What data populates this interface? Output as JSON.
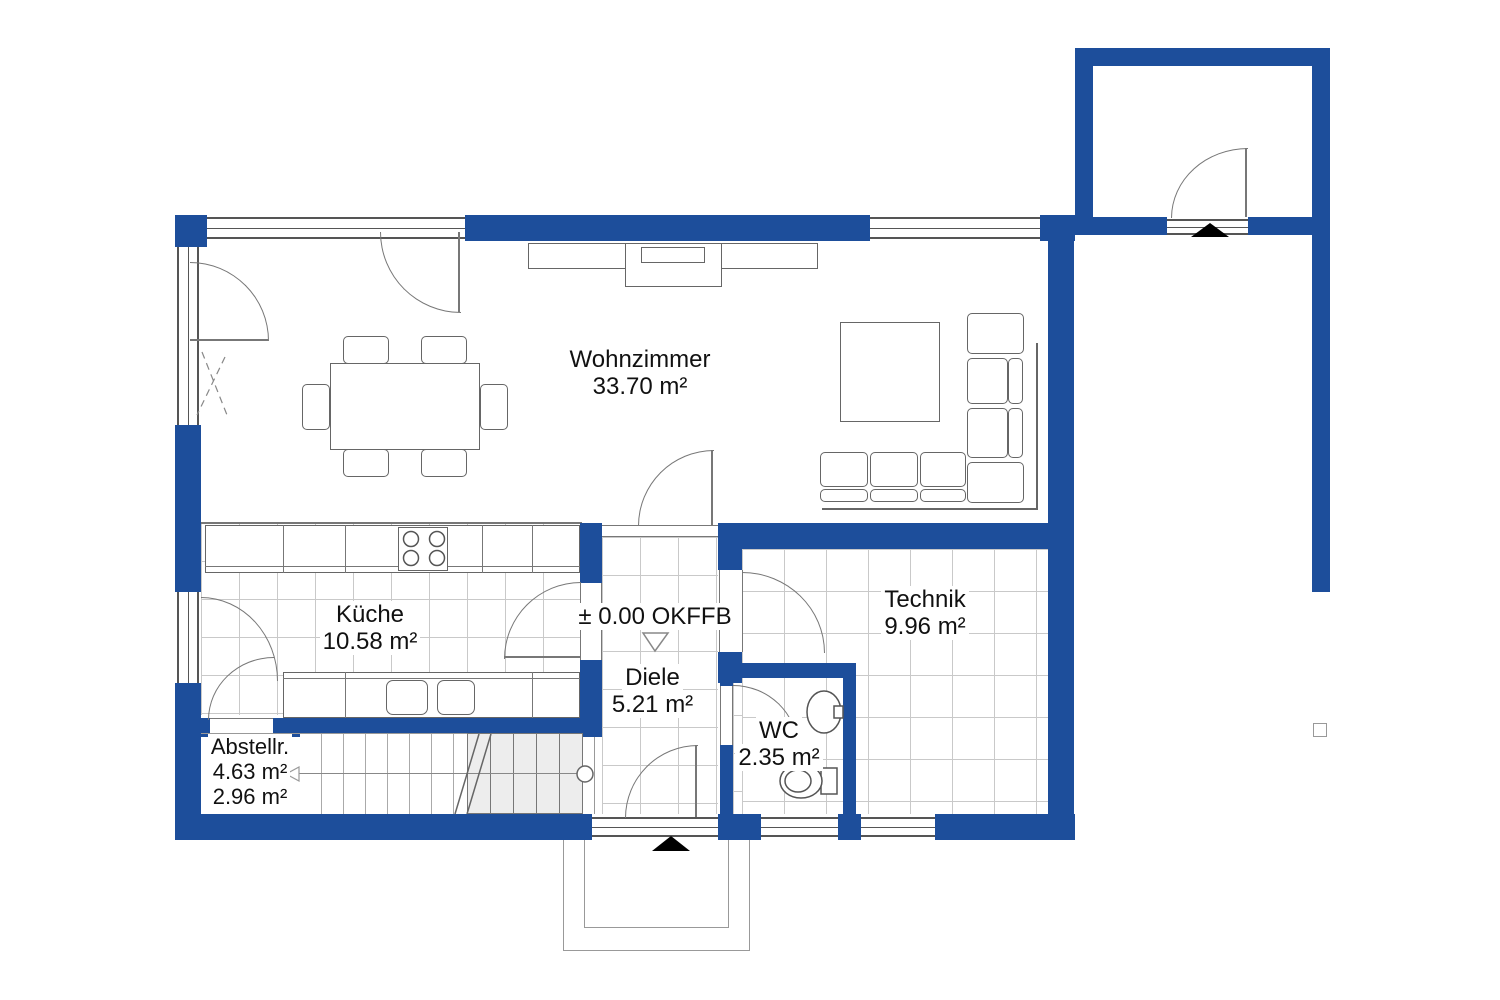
{
  "colors": {
    "wall": "#1d4e9b",
    "line": "#666666",
    "tile": "#c9c9c9",
    "stair_fill": "#ededed",
    "text": "#111111"
  },
  "rooms": [
    {
      "id": "wohnzimmer",
      "name": "Wohnzimmer",
      "area": "33.70 m²"
    },
    {
      "id": "kueche",
      "name": "Küche",
      "area": "10.58 m²"
    },
    {
      "id": "diele",
      "name": "Diele",
      "area": "5.21 m²"
    },
    {
      "id": "wc",
      "name": "WC",
      "area": "2.35 m²"
    },
    {
      "id": "technik",
      "name": "Technik",
      "area": "9.96 m²"
    },
    {
      "id": "abstellraum",
      "name": "Abstellr.",
      "area": "4.63 m²",
      "area2": "2.96 m²"
    }
  ],
  "annotations": {
    "level_marker": "± 0.00 OKFFB"
  },
  "symbols": {
    "entrance_marker": "▲",
    "level_marker_triangle": "▽",
    "stair_direction_arrow": "◁"
  }
}
